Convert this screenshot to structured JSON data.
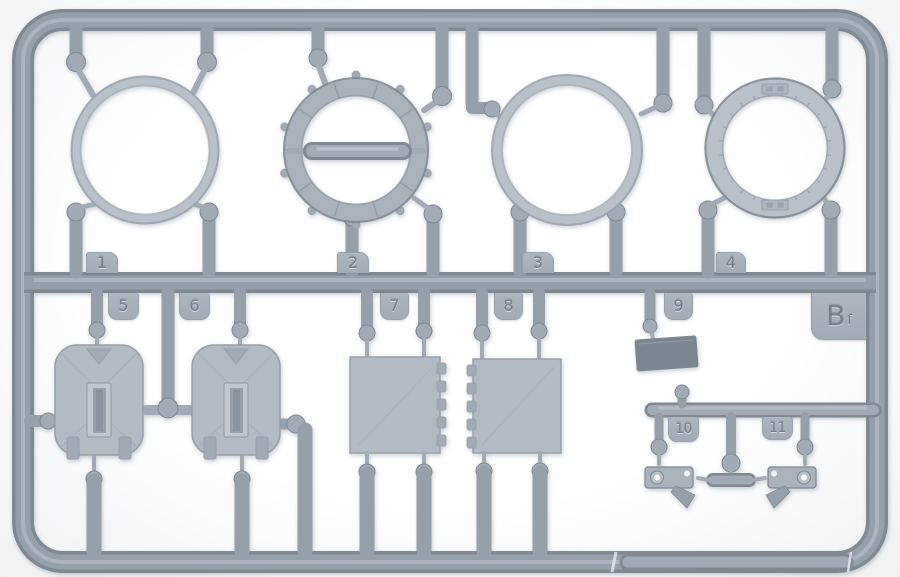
{
  "scene": {
    "description": "Grey injection-moulded plastic model-kit sprue (parts runner) photographed on a white background. Four wheel/ring parts sit along the top row; two hatches, two hinged panels, a small block and two tow-hook fittings sit below the central runner. Moulded tags number the parts 1-11 and a corner tag carries the runner letter."
  },
  "colors": {
    "background": "#f6f7f8",
    "plastic_edge": "#7e8994",
    "plastic_mid": "#96a0ab",
    "plastic_body": "#a2abb5",
    "plastic_light": "#b9c0c9",
    "plastic_highlight": "#c0c7cf",
    "plastic_band": "#aab2bb",
    "plastic_panel": "#b2bac3",
    "plastic_dark": "#7b8693",
    "tab_face": "#aeb6bf",
    "tab_border": "#97a1ac",
    "tab_text": "#76818e"
  },
  "tags": {
    "n1": "1",
    "n2": "2",
    "n3": "3",
    "n4": "4",
    "n5": "5",
    "n6": "6",
    "n7": "7",
    "n8": "8",
    "n9": "9",
    "n10": "10",
    "n11": "11",
    "letter": "B",
    "letter_suffix": "f"
  }
}
